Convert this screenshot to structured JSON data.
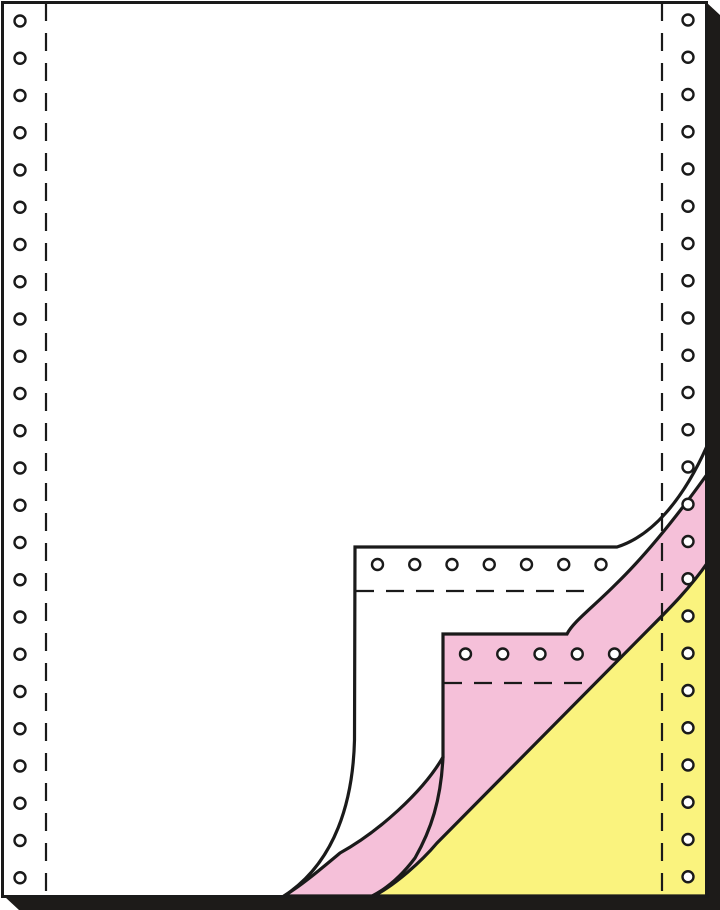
{
  "figure": {
    "kind": "continuous-form-paper-product-illustration",
    "plies": [
      "white",
      "pink",
      "yellow"
    ],
    "canvas": {
      "w": 720,
      "h": 910,
      "background": "#ffffff"
    },
    "colors": {
      "line": "#1a1a1a",
      "shadow": "#1d1b19",
      "sheet_white": "#ffffff",
      "sheet_pink": "#f5c0d9",
      "sheet_yellow": "#faf37e",
      "hole_fill": "#ffffff"
    },
    "strokes": {
      "page_border": 3,
      "curl_line": 3.2,
      "dash_line": 2.2,
      "hole_ring": 2.4
    },
    "dash_pattern": "18 12",
    "page_border": {
      "x": 2.5,
      "y": 2.5,
      "w": 704,
      "h": 894
    },
    "page_fill": {
      "x": 0,
      "y": 0,
      "w": 707,
      "h": 897
    },
    "shadow_points": "706,2 720,15 720,910 19,910 5,897 706,897",
    "paths": {
      "pink_sheet": "M708,473 C678,515 645,556 615,585 C592,608 573,622 567,634 L443,634 L443,757 C423,792 378,832 340,853 C322,868 302,885 284,896 L707,896 L707,473 Z",
      "yellow_sheet": "M708,562 C690,588 670,608 650,628 L437,843 C421,862 396,884 374,896 L707,896 L707,562 Z",
      "white_curl_outline": "M707,446 C683,500 652,536 617,547 L355,547 L354.5,740 C353,800 336,862 284,896",
      "pink_curl_lower_edge": "M443,757 C441,800 431,830 415,858 C400,878 386,889 372,896"
    },
    "dashed_lines": {
      "left_vertical": {
        "x": 46,
        "y1": 3,
        "y2": 895
      },
      "right_vertical": {
        "x": 662,
        "y1": 3,
        "y2": 895
      },
      "white_band_horizontal": {
        "y": 591,
        "x1": 356,
        "x2": 596
      },
      "pink_band_horizontal": {
        "y": 683,
        "x1": 444,
        "x2": 586
      }
    },
    "holes": {
      "radius": 5.5,
      "spacing": 37.25,
      "columns": [
        {
          "name": "left-sprocket-column",
          "cx": 20,
          "cy0": 21,
          "count": 24
        },
        {
          "name": "right-sprocket-column",
          "cx": 688,
          "cy0": 20,
          "count": 24
        }
      ],
      "rows": [
        {
          "name": "white-band-sprocket-row",
          "cy": 564.5,
          "cx0": 377.5,
          "count": 7
        },
        {
          "name": "pink-band-sprocket-row",
          "cy": 654,
          "cx0": 465.5,
          "count": 5
        }
      ]
    }
  }
}
